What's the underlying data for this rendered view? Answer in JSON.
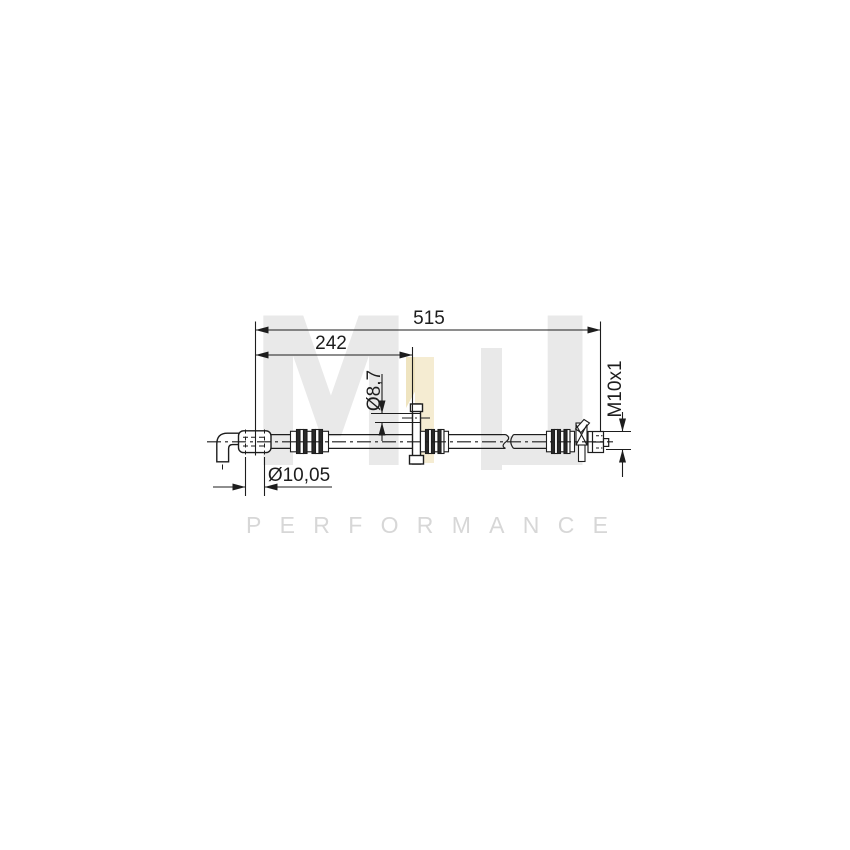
{
  "meta": {
    "background_color": "#ffffff",
    "line_color": "#1d1d1d",
    "description": "Technical line drawing of a brake hose with dimension annotations"
  },
  "watermark": {
    "brand_letters": "ML",
    "letter_m": "M",
    "letter_l": "L",
    "subtitle": "PERFORMANCE",
    "letter_gray": "#e9e9e9",
    "subtitle_gray": "#d7d7d7",
    "accent_cream": "#f5ecd2",
    "accent_cream_dark": "#efe4c0"
  },
  "drawing": {
    "dimensions": {
      "overall_length": "515",
      "intermediate_length": "242",
      "bracket_hole_diameter": "Ø8,7",
      "thread": "M10x1",
      "end_diameter": "Ø10,05"
    }
  }
}
